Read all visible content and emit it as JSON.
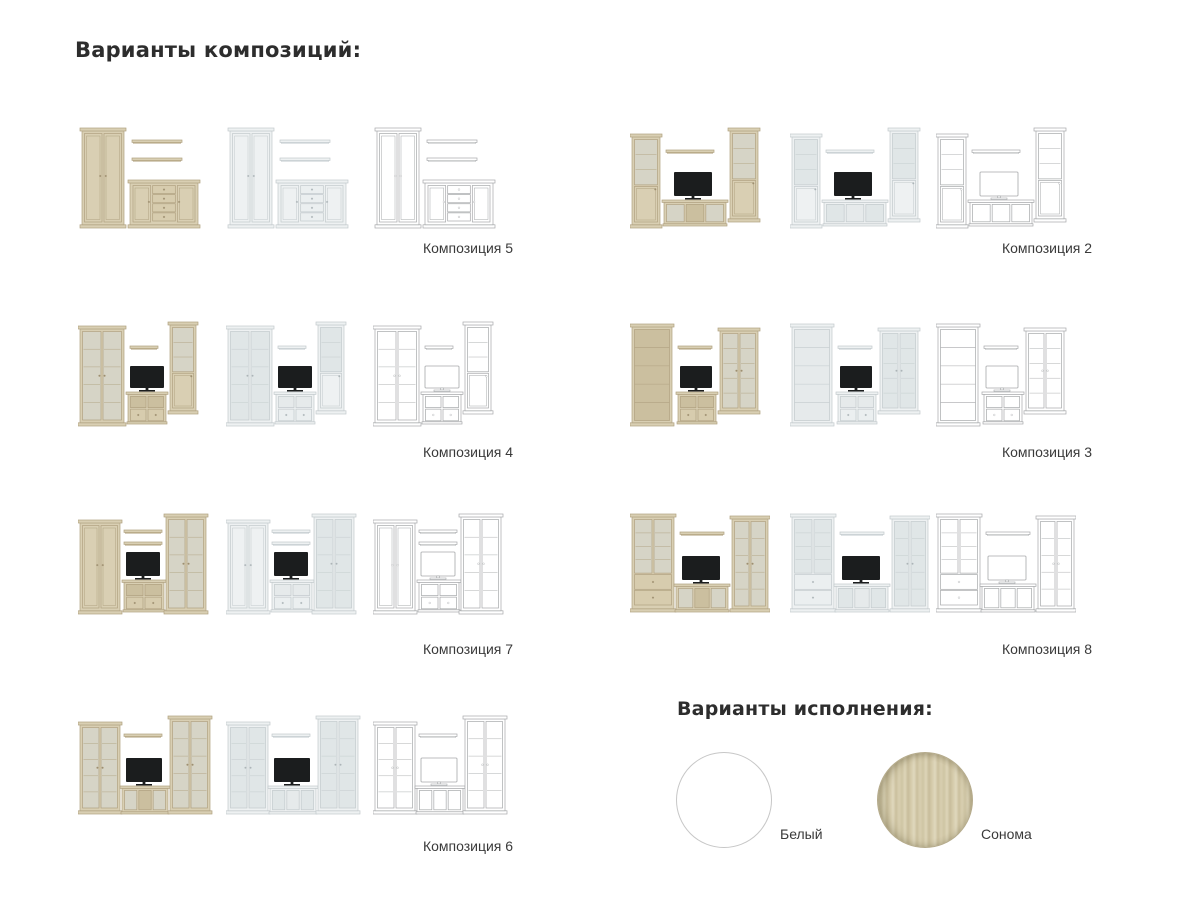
{
  "page": {
    "title": "Варианты композиций:",
    "finishes_title": "Варианты исполнения:"
  },
  "compositions": [
    {
      "id": "5",
      "label": "Композиция 5",
      "modules": [
        {
          "t": "wardrobe",
          "x": 4,
          "y": 6,
          "w": 42,
          "h": 100
        },
        {
          "t": "shelf",
          "x": 54,
          "y": 18,
          "w": 50
        },
        {
          "t": "shelf",
          "x": 54,
          "y": 36,
          "w": 50
        },
        {
          "t": "sideboard",
          "x": 52,
          "y": 58,
          "w": 68,
          "h": 48
        }
      ]
    },
    {
      "id": "2",
      "label": "Композиция 2",
      "modules": [
        {
          "t": "narrowGlass",
          "x": 2,
          "y": 12,
          "w": 28,
          "h": 94
        },
        {
          "t": "shelf",
          "x": 36,
          "y": 28,
          "w": 48
        },
        {
          "t": "tv",
          "x": 44,
          "y": 50,
          "w": 38,
          "h": 28
        },
        {
          "t": "tvstand3o",
          "x": 34,
          "y": 78,
          "w": 62,
          "h": 26
        },
        {
          "t": "narrowGlass",
          "x": 100,
          "y": 6,
          "w": 28,
          "h": 94
        }
      ]
    },
    {
      "id": "4",
      "label": "Композиция 4",
      "modules": [
        {
          "t": "glass2",
          "x": 2,
          "y": 6,
          "w": 44,
          "h": 100
        },
        {
          "t": "shelf",
          "x": 52,
          "y": 26,
          "w": 28
        },
        {
          "t": "tv",
          "x": 52,
          "y": 46,
          "w": 34,
          "h": 26
        },
        {
          "t": "tvstand2d",
          "x": 50,
          "y": 72,
          "w": 38,
          "h": 32
        },
        {
          "t": "narrowGlass",
          "x": 92,
          "y": 2,
          "w": 26,
          "h": 92
        }
      ]
    },
    {
      "id": "3",
      "label": "Композиция 3",
      "modules": [
        {
          "t": "bookcase",
          "x": 2,
          "y": 4,
          "w": 40,
          "h": 102
        },
        {
          "t": "shelf",
          "x": 48,
          "y": 26,
          "w": 34
        },
        {
          "t": "tv",
          "x": 50,
          "y": 46,
          "w": 32,
          "h": 26
        },
        {
          "t": "tvstand2d",
          "x": 48,
          "y": 72,
          "w": 38,
          "h": 32
        },
        {
          "t": "glass2",
          "x": 90,
          "y": 8,
          "w": 38,
          "h": 86
        }
      ]
    },
    {
      "id": "7",
      "label": "Композиция 7",
      "modules": [
        {
          "t": "wardrobe",
          "x": 2,
          "y": 12,
          "w": 40,
          "h": 94
        },
        {
          "t": "shelf",
          "x": 46,
          "y": 22,
          "w": 38
        },
        {
          "t": "shelf",
          "x": 46,
          "y": 34,
          "w": 38
        },
        {
          "t": "tv",
          "x": 48,
          "y": 44,
          "w": 34,
          "h": 28
        },
        {
          "t": "tvstand2d",
          "x": 46,
          "y": 72,
          "w": 40,
          "h": 32
        },
        {
          "t": "glass2",
          "x": 88,
          "y": 6,
          "w": 40,
          "h": 100
        }
      ]
    },
    {
      "id": "8",
      "label": "Композиция 8",
      "modules": [
        {
          "t": "glassDrawers",
          "x": 2,
          "y": 6,
          "w": 42,
          "h": 98
        },
        {
          "t": "shelf",
          "x": 50,
          "y": 24,
          "w": 44
        },
        {
          "t": "tv",
          "x": 52,
          "y": 48,
          "w": 38,
          "h": 28
        },
        {
          "t": "tvstand3o",
          "x": 46,
          "y": 76,
          "w": 52,
          "h": 28
        },
        {
          "t": "glass2",
          "x": 102,
          "y": 8,
          "w": 36,
          "h": 96
        }
      ]
    },
    {
      "id": "6",
      "label": "Композиция 6",
      "modules": [
        {
          "t": "glass2",
          "x": 2,
          "y": 14,
          "w": 40,
          "h": 92
        },
        {
          "t": "shelf",
          "x": 46,
          "y": 26,
          "w": 38
        },
        {
          "t": "tv",
          "x": 48,
          "y": 50,
          "w": 36,
          "h": 28
        },
        {
          "t": "tvstand3o",
          "x": 44,
          "y": 78,
          "w": 46,
          "h": 28
        },
        {
          "t": "glass2",
          "x": 92,
          "y": 8,
          "w": 40,
          "h": 98
        }
      ]
    }
  ],
  "finishes": [
    {
      "name": "Белый",
      "swatch": "white"
    },
    {
      "name": "Сонома",
      "swatch": "sonoma"
    }
  ],
  "palettes": {
    "sonoma": {
      "body": "#d9cfb3",
      "edge": "#c6b996",
      "stroke": "#b0a180",
      "glass": "#d6d4c6",
      "inner": "#cbbf9f",
      "drawer": "#d7ccae",
      "knob": "#998c6f"
    },
    "white": {
      "body": "#eef1f2",
      "edge": "#d9dfe1",
      "stroke": "#c2c9cc",
      "glass": "#e0e6e7",
      "inner": "#e6eaeb",
      "drawer": "#ebeff0",
      "knob": "#a9b1b4"
    },
    "wire": {
      "body": "#ffffff",
      "edge": "#ffffff",
      "stroke": "#a6a8aa",
      "glass": "#ffffff",
      "inner": "#ffffff",
      "drawer": "#ffffff",
      "knob": "#ffffff"
    }
  },
  "tv": {
    "screen": "#1b1d1e"
  }
}
